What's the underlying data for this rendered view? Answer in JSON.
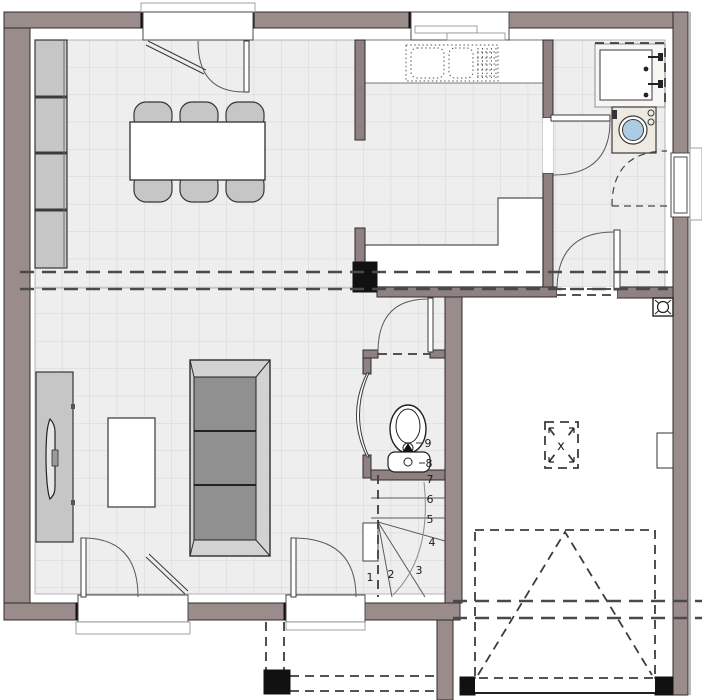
{
  "drawing": {
    "kind": "ground-floor-plan"
  },
  "stairs": {
    "step_labels": [
      "1",
      "2",
      "3",
      "4",
      "5",
      "6",
      "7",
      "8",
      "9"
    ]
  },
  "markers": {
    "roof_opening_label": "x"
  },
  "colors": {
    "wall": "#9b8c8c",
    "outline": "#2e2a29",
    "floor_tile": "#eeeeef",
    "tile_grid": "#d5d5d8",
    "furniture_gray": "#c6c6c6",
    "sofa_cushion": "#8f8f8f",
    "washer_door_blue": "#aecbe4",
    "post_black": "#111111"
  }
}
